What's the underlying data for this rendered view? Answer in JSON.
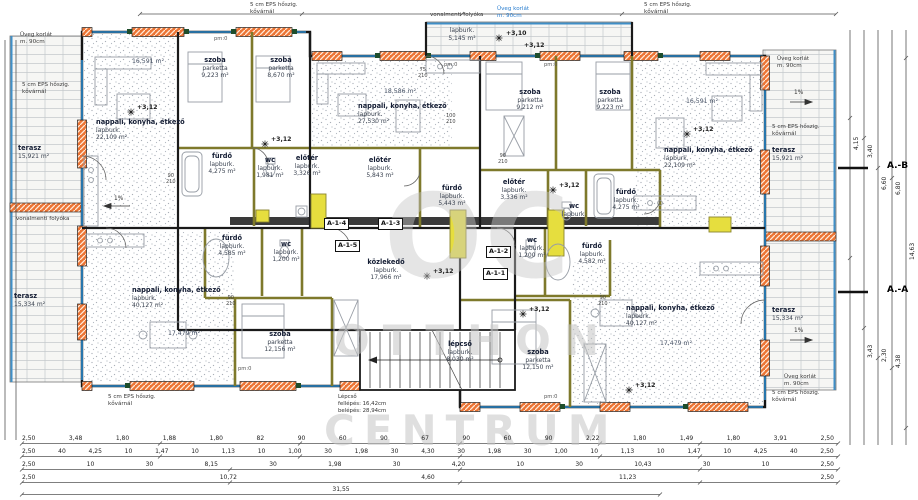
{
  "plan": {
    "watermark": {
      "logo": "OC",
      "line1": "OTTHON",
      "line2": "CENTRUM"
    },
    "units": [
      {
        "id": "A-1-4"
      },
      {
        "id": "A-1-3"
      },
      {
        "id": "A-1-5"
      },
      {
        "id": "A-1-2"
      },
      {
        "id": "A-1-1"
      }
    ],
    "rooms": [
      {
        "name": "nappali, konyha, étkező",
        "finish": "lapburk.",
        "area": "22,109 m²"
      },
      {
        "name": "szoba",
        "finish": "parketta",
        "area": "9,223 m²"
      },
      {
        "name": "szoba",
        "finish": "parketta",
        "area": "8,670 m²"
      },
      {
        "name": "fürdő",
        "finish": "lapburk.",
        "area": "4,275 m²"
      },
      {
        "name": "wc",
        "finish": "lapburk.",
        "area": "1,981 m²"
      },
      {
        "name": "előtér",
        "finish": "lapburk.",
        "area": "3,326 m²"
      },
      {
        "name": "",
        "finish": "lapburk.",
        "area": "5,145 m²"
      },
      {
        "name": "nappali, konyha, étkező",
        "finish": "lapburk.",
        "area": "27,530 m²"
      },
      {
        "name": "előtér",
        "finish": "lapburk.",
        "area": "5,843 m²"
      },
      {
        "name": "fürdő",
        "finish": "lapburk.",
        "area": "5,443 m²"
      },
      {
        "name": "szoba",
        "finish": "parketta",
        "area": "9,212 m²"
      },
      {
        "name": "szoba",
        "finish": "parketta",
        "area": "9,223 m²"
      },
      {
        "name": "előtér",
        "finish": "lapburk.",
        "area": "3,336 m²"
      },
      {
        "name": "wc",
        "finish": "lapburk.",
        "area": ""
      },
      {
        "name": "fürdő",
        "finish": "lapburk.",
        "area": "4,275 m²"
      },
      {
        "name": "nappali, konyha, étkező",
        "finish": "lapburk.",
        "area": "22,109 m²"
      },
      {
        "name": "közlekedő",
        "finish": "lapburk.",
        "area": "17,966 m²"
      },
      {
        "name": "lépcső",
        "finish": "lapburk.",
        "area": "8,030 m²"
      },
      {
        "name": "fürdő",
        "finish": "lapburk.",
        "area": "4,585 m²"
      },
      {
        "name": "wc",
        "finish": "lapburk.",
        "area": "1,200 m²"
      },
      {
        "name": "nappali, konyha, étkező",
        "finish": "lapburk.",
        "area": "40,127 m²"
      },
      {
        "name": "szoba",
        "finish": "parketta",
        "area": "12,156 m²"
      },
      {
        "name": "wc",
        "finish": "lapburk.",
        "area": "1,200 m²"
      },
      {
        "name": "fürdő",
        "finish": "lapburk.",
        "area": "4,582 m²"
      },
      {
        "name": "nappali, konyha, étkező",
        "finish": "lapburk.",
        "area": "40,127 m²"
      },
      {
        "name": "szoba",
        "finish": "parketta",
        "area": "12,150 m²"
      },
      {
        "name": "terasz",
        "finish": "",
        "area": "15,921 m²"
      },
      {
        "name": "terasz",
        "finish": "",
        "area": "15,334 m²"
      },
      {
        "name": "terasz",
        "finish": "",
        "area": "15,921 m²"
      },
      {
        "name": "terasz",
        "finish": "",
        "area": "15,334 m²"
      }
    ],
    "extras": [
      "16,591 m²",
      "18,586 m²",
      "16,591 m²",
      "17,479 m²",
      "17,479 m²"
    ],
    "levels": [
      "+3,12",
      "+3,10",
      "+3,12",
      "+3,12",
      "+3,12",
      "+3,12",
      "+3,12",
      "+3,12",
      "+3,12"
    ],
    "notes": [
      "Üveg korlát\nm. 90cm",
      "5 cm EPS hőszig.\nkővárnál",
      "5 cm EPS hőszig.\nkővárnál",
      "vonalmenti folyóka",
      "Üveg korlát\nm. 90cm",
      "5 cm EPS hőszig.\nkővárnál",
      "Üveg korlát\nm. 90cm",
      "5 cm EPS hőszig.\nkővárnál",
      "vonalmenti folyóka",
      "5 cm EPS hőszig.\nkővárnál",
      "Üveg korlát\nm. 90cm",
      "5 cm EPS hőszig.\nkővárnál"
    ],
    "stair_note": "Lépcső\nfellépés: 16,42cm\nbelépés: 28,94cm",
    "door_labels": [
      "90\n210",
      "75\n210",
      "90\n210",
      "100\n210",
      "90\n210",
      "90\n210"
    ],
    "pm_labels": [
      "pm:0",
      "pm:0",
      "pm:0",
      "pm:0",
      "pm:0"
    ],
    "slope_labels": [
      "1%",
      "1%",
      "1%"
    ],
    "sections": {
      "ab": "A.-B",
      "aa": "A.-A"
    },
    "dims": {
      "row1": [
        "2,50",
        "3,48",
        "1,80",
        "1,88",
        "1,80",
        "82",
        "90",
        "60",
        "90",
        "67",
        "90",
        "60",
        "90",
        "2,22",
        "1,80",
        "1,49",
        "1,80",
        "3,91",
        "2,50"
      ],
      "row2": [
        "2,50",
        "40",
        "4,25",
        "10",
        "1,47",
        "10",
        "1,13",
        "10",
        "1,00",
        "30",
        "1,98",
        "30",
        "4,30",
        "30",
        "1,98",
        "30",
        "1,00",
        "10",
        "1,13",
        "10",
        "1,47",
        "10",
        "4,25",
        "40",
        "2,50"
      ],
      "row3": [
        "2,50",
        "10",
        "30",
        "8,15",
        "30",
        "1,98",
        "30",
        "4,20",
        "10",
        "30",
        "10,43",
        "30",
        "10",
        "2,50"
      ],
      "row4": [
        "2,50",
        "10,72",
        "4,60",
        "11,23",
        "2,50"
      ],
      "row5": [
        "31,55"
      ],
      "right": [
        "4,15",
        "3,40",
        "6,60",
        "6,80",
        "14,63",
        "3,43",
        "2,30",
        "4,38"
      ]
    }
  }
}
